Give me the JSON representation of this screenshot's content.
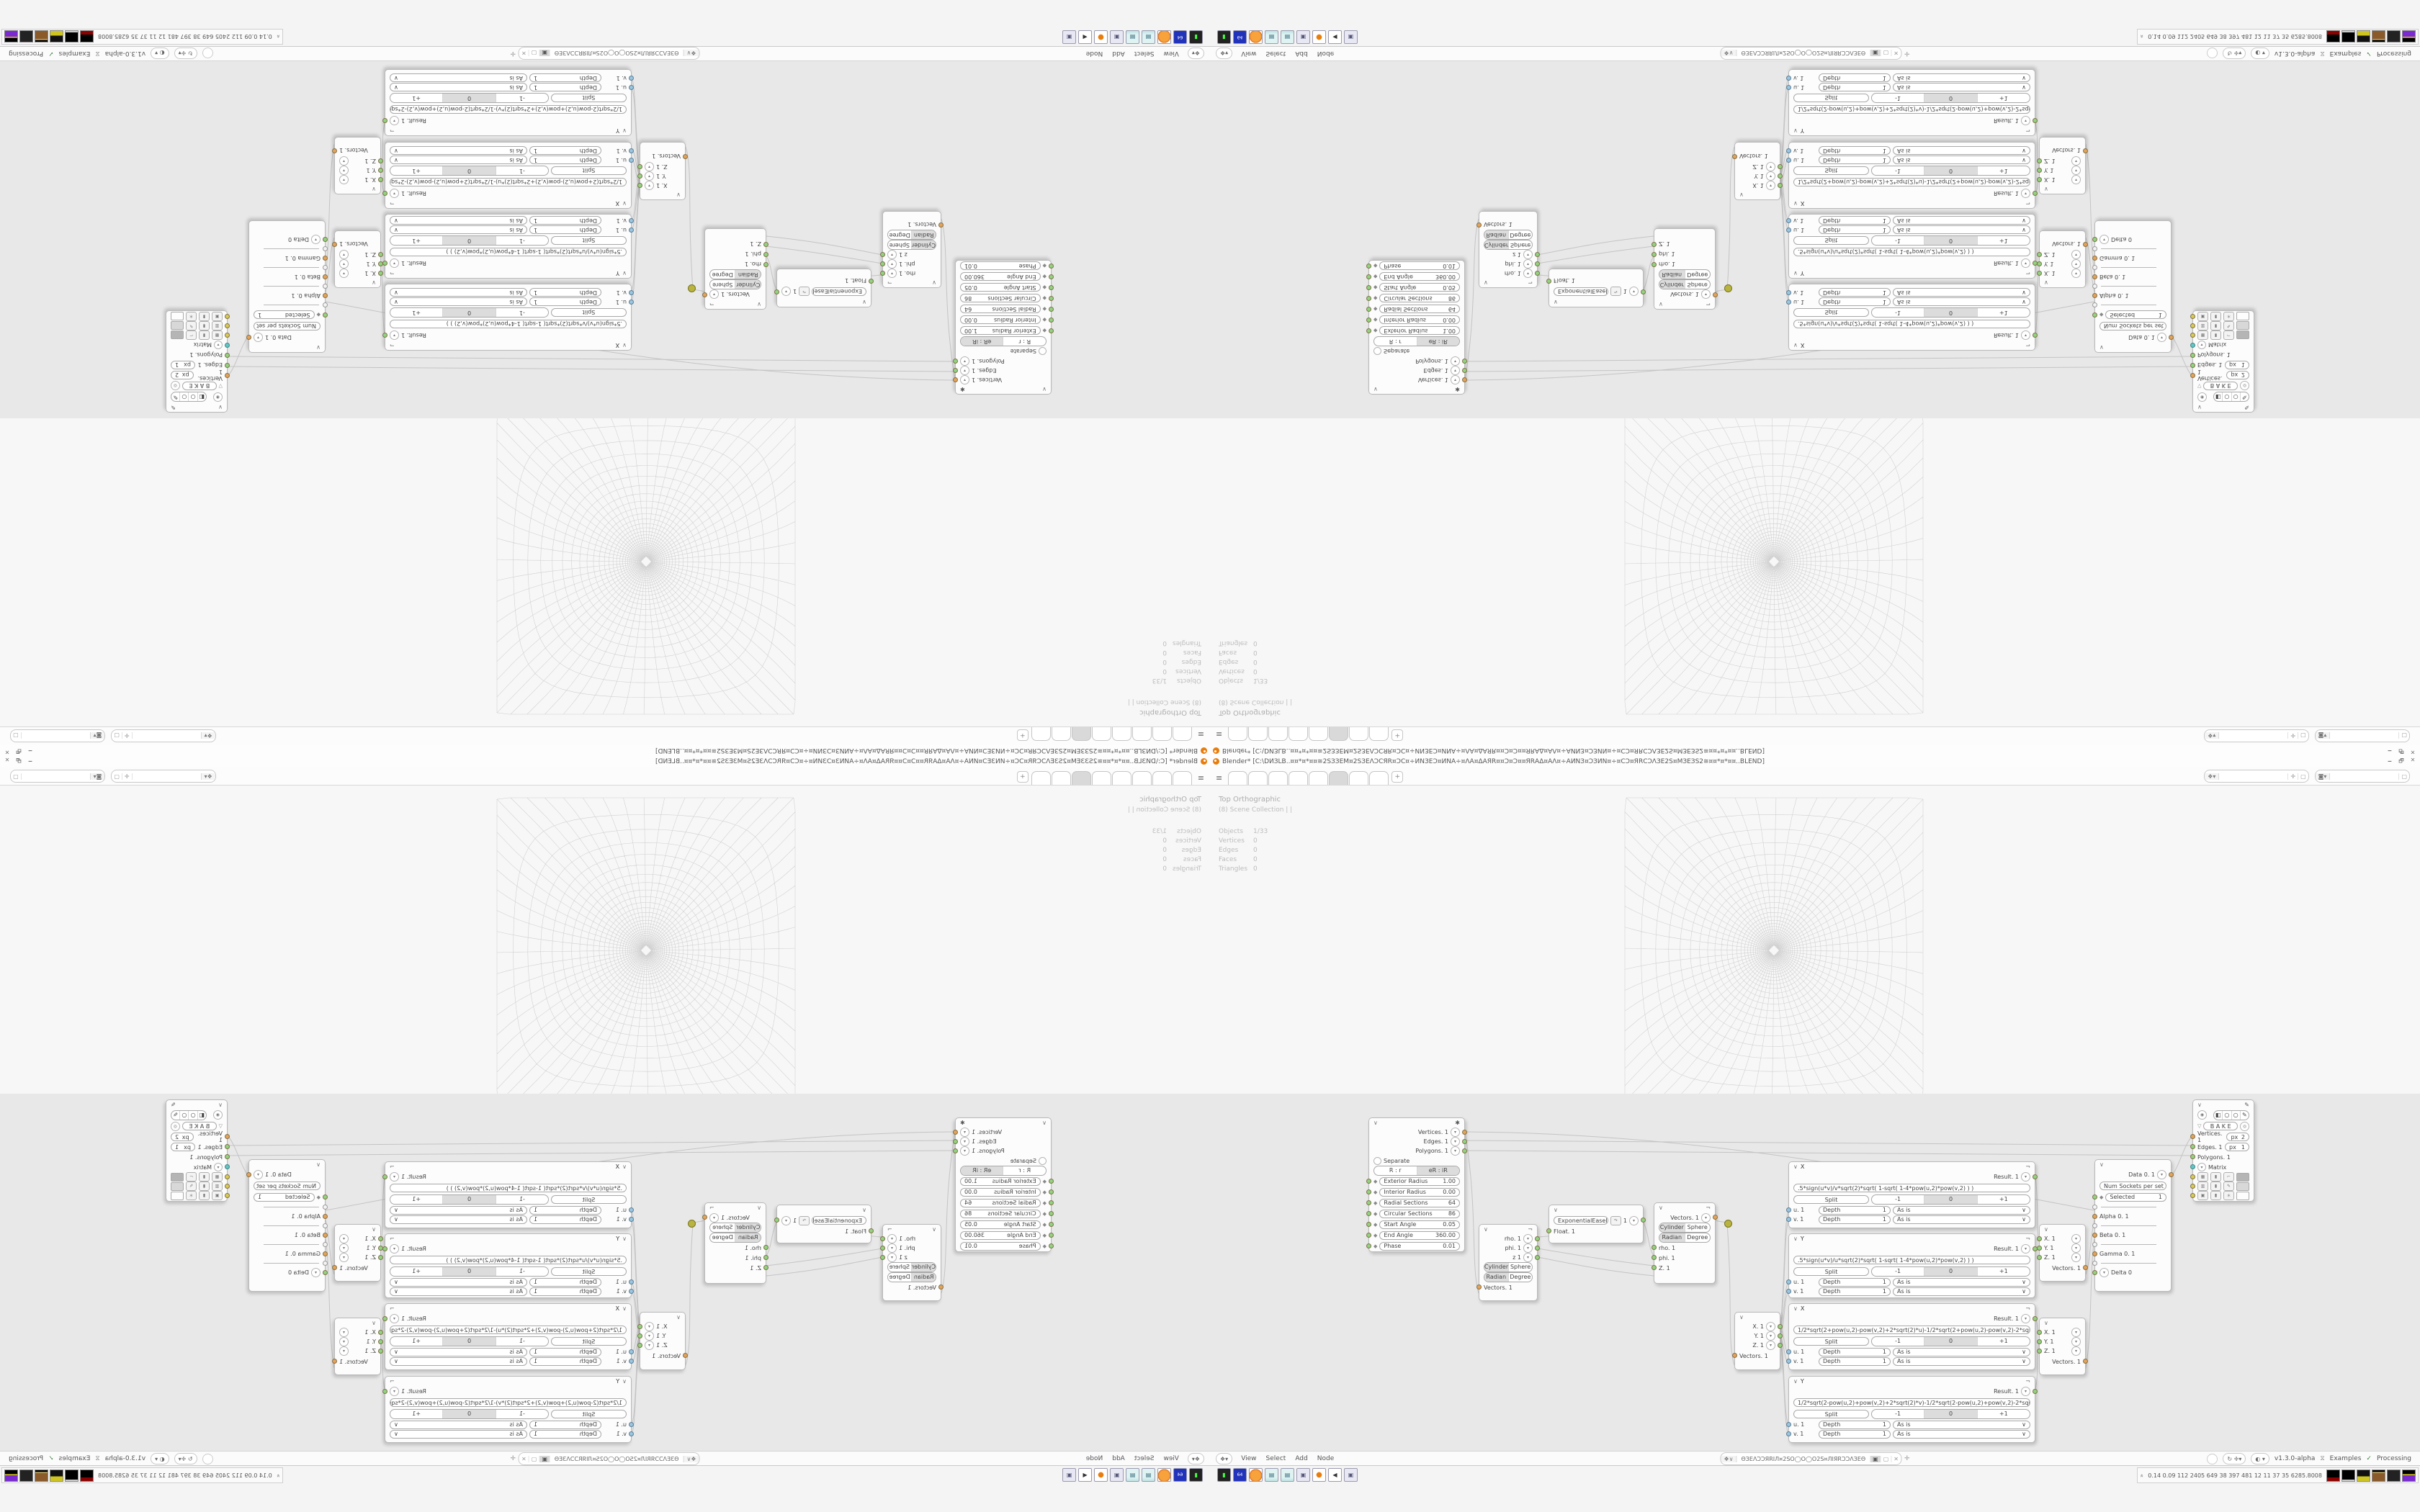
{
  "window": {
    "title": "Blender* [C:\\DИЗLB..¤¤*¤*¤¤≅2SЗЗЕМ¤2SЗЕΛƆСЯR¤ƆС¤÷ИNЗЕƆ¤ИNА÷¤ΛА¤ΔАЯR¤¤Ɔ¤Ɔ¤¤ЯRАΔ¤АΛ¤÷АИNЗ¤ƆЗИN¤÷¤СƆ¤ЯRСƆΛЗЕ2S¤МЗЕЗS2≅¤¤*¤*¤¤..BLEND]",
    "minimize": "🗕",
    "maximize": "🗗",
    "close": "✕"
  },
  "topbar": {
    "new_tab": "+"
  },
  "viewport": {
    "view_label": "Top Orthographic",
    "collection_label": "(8) Scene Collection | |",
    "stats": {
      "rows": [
        {
          "label": "Objects",
          "value": "1/33"
        },
        {
          "label": "Vertices",
          "value": "0"
        },
        {
          "label": "Edges",
          "value": "0"
        },
        {
          "label": "Faces",
          "value": "0"
        },
        {
          "label": "Triangles",
          "value": "0"
        }
      ]
    },
    "header": {
      "mode": "Object Mode",
      "menu_view": "View",
      "menu_select": "Select",
      "menu_add": "Add",
      "menu_object": "Object",
      "orientation": "Global"
    }
  },
  "node_editor": {
    "header": {
      "menu_view": "View",
      "menu_select": "Select",
      "menu_add": "Add",
      "menu_node": "Node",
      "tree_name": "ΘЗЕΛƆƆЯRIЛ¤2SO◯O◯O2S¤ЛIЯRƆƆΛЗЕΘ",
      "version": "v1.3.0-alpha",
      "examples_label": "Examples",
      "processing_label": "Processing"
    },
    "ring": {
      "out_vertices": "Vertices. 1",
      "out_edges": "Edges. 1",
      "out_polygons": "Polygons. 1",
      "separate_label": "Separate",
      "mode_a": "R : r",
      "mode_b": "eR : iR",
      "params": [
        {
          "label": "Exterior Radius",
          "value": "1.00"
        },
        {
          "label": "Interior Radius",
          "value": "0.00"
        },
        {
          "label": "Radial Sections",
          "value": "64"
        },
        {
          "label": "Circular Sections",
          "value": "86"
        },
        {
          "label": "Start Angle",
          "value": "0.05"
        },
        {
          "label": "End Angle",
          "value": "360.00"
        },
        {
          "label": "Phase",
          "value": "0.01"
        }
      ]
    },
    "polar_out": {
      "out_rho": "rho. 1",
      "out_phi": "phi. 1",
      "out_z": "z 1",
      "mode1a": "Cylinder",
      "mode1b": "Sphere",
      "mode2a": "Radian",
      "mode2b": "Degree",
      "input": "Vectors. 1"
    },
    "easing": {
      "function": "ExponentialEaseIn",
      "value": "1",
      "input": "Float. 1"
    },
    "polar_in": {
      "output": "Vectors. 1",
      "mode1a": "Cylinder",
      "mode1b": "Sphere",
      "mode2a": "Radian",
      "mode2b": "Degree",
      "in_rho": "rho. 1",
      "in_phi": "phi. 1",
      "in_z": "Z. 1"
    },
    "vector_out": {
      "out_x": "X. 1",
      "out_y": "Y. 1",
      "out_z": "Z. 1",
      "input": "Vectors. 1"
    },
    "formula_common": {
      "result": "Result. 1",
      "split": "Split",
      "wrap_m1": "-1",
      "wrap_0": "0",
      "wrap_p1": "+1",
      "u": "u. 1",
      "v": "v. 1",
      "depth": "Depth",
      "depth_value": "1",
      "list_mode": "As is"
    },
    "formulas": [
      {
        "title": "X",
        "formula": ".5*sign(u*v)/v*sqrt(2)*sqrt(      1-sqrt(      1-4*pow(u,2)*pow(v,2)      )      )"
      },
      {
        "title": "Y",
        "formula": ".5*sign(u*v)/u*sqrt(2)*sqrt(      1-sqrt(      1-4*pow(u,2)*pow(v,2)      )      )"
      },
      {
        "title": "X",
        "formula": "1/2*sqrt(2+pow(u,2)-pow(v,2)+2*sqrt(2)*u)-1/2*sqrt(2+pow(u,2)-pow(v,2)-2*sqrt(2)*u)"
      },
      {
        "title": "Y",
        "formula": "1/2*sqrt(2-pow(u,2)+pow(v,2)+2*sqrt(2)*v)-1/2*sqrt(2-pow(u,2)+pow(v,2)-2*sqrt(2)*v)"
      }
    ],
    "vector_in": {
      "output": "Vectors. 1",
      "in_x": "X. 1",
      "in_y": "Y. 1",
      "in_z": "Z. 1"
    },
    "input_switch": {
      "output": "Data 0. 1",
      "num_label": "Num Sockets per set",
      "num_value": "1",
      "sel_label": "Selected",
      "sel_value": "1",
      "in_alpha": "Alpha 0. 1",
      "in_beta": "Beta 0. 1",
      "in_gamma": "Gamma 0. 1",
      "in_delta": "Delta 0"
    },
    "viewer": {
      "bake": "B A K E",
      "in_vertices": "Vertices. 1",
      "in_edges": "Edges. 1",
      "in_polygons": "Polygons. 1",
      "in_matrix": "Matrix",
      "px_label": "px",
      "px_verts": "2",
      "px_edges": "1"
    }
  },
  "taskbar": {
    "icons": [
      "launcher-icon",
      "floppy-64-icon",
      "firefox-icon",
      "notepad-icon",
      "notepad-icon",
      "window-icon",
      "blender-icon",
      "audio-icon",
      "window-icon"
    ],
    "floppy_label": "64",
    "stats": "0.14 0.09   112 2405 649   38   397 481   12   11   37   35   6285.8008"
  }
}
